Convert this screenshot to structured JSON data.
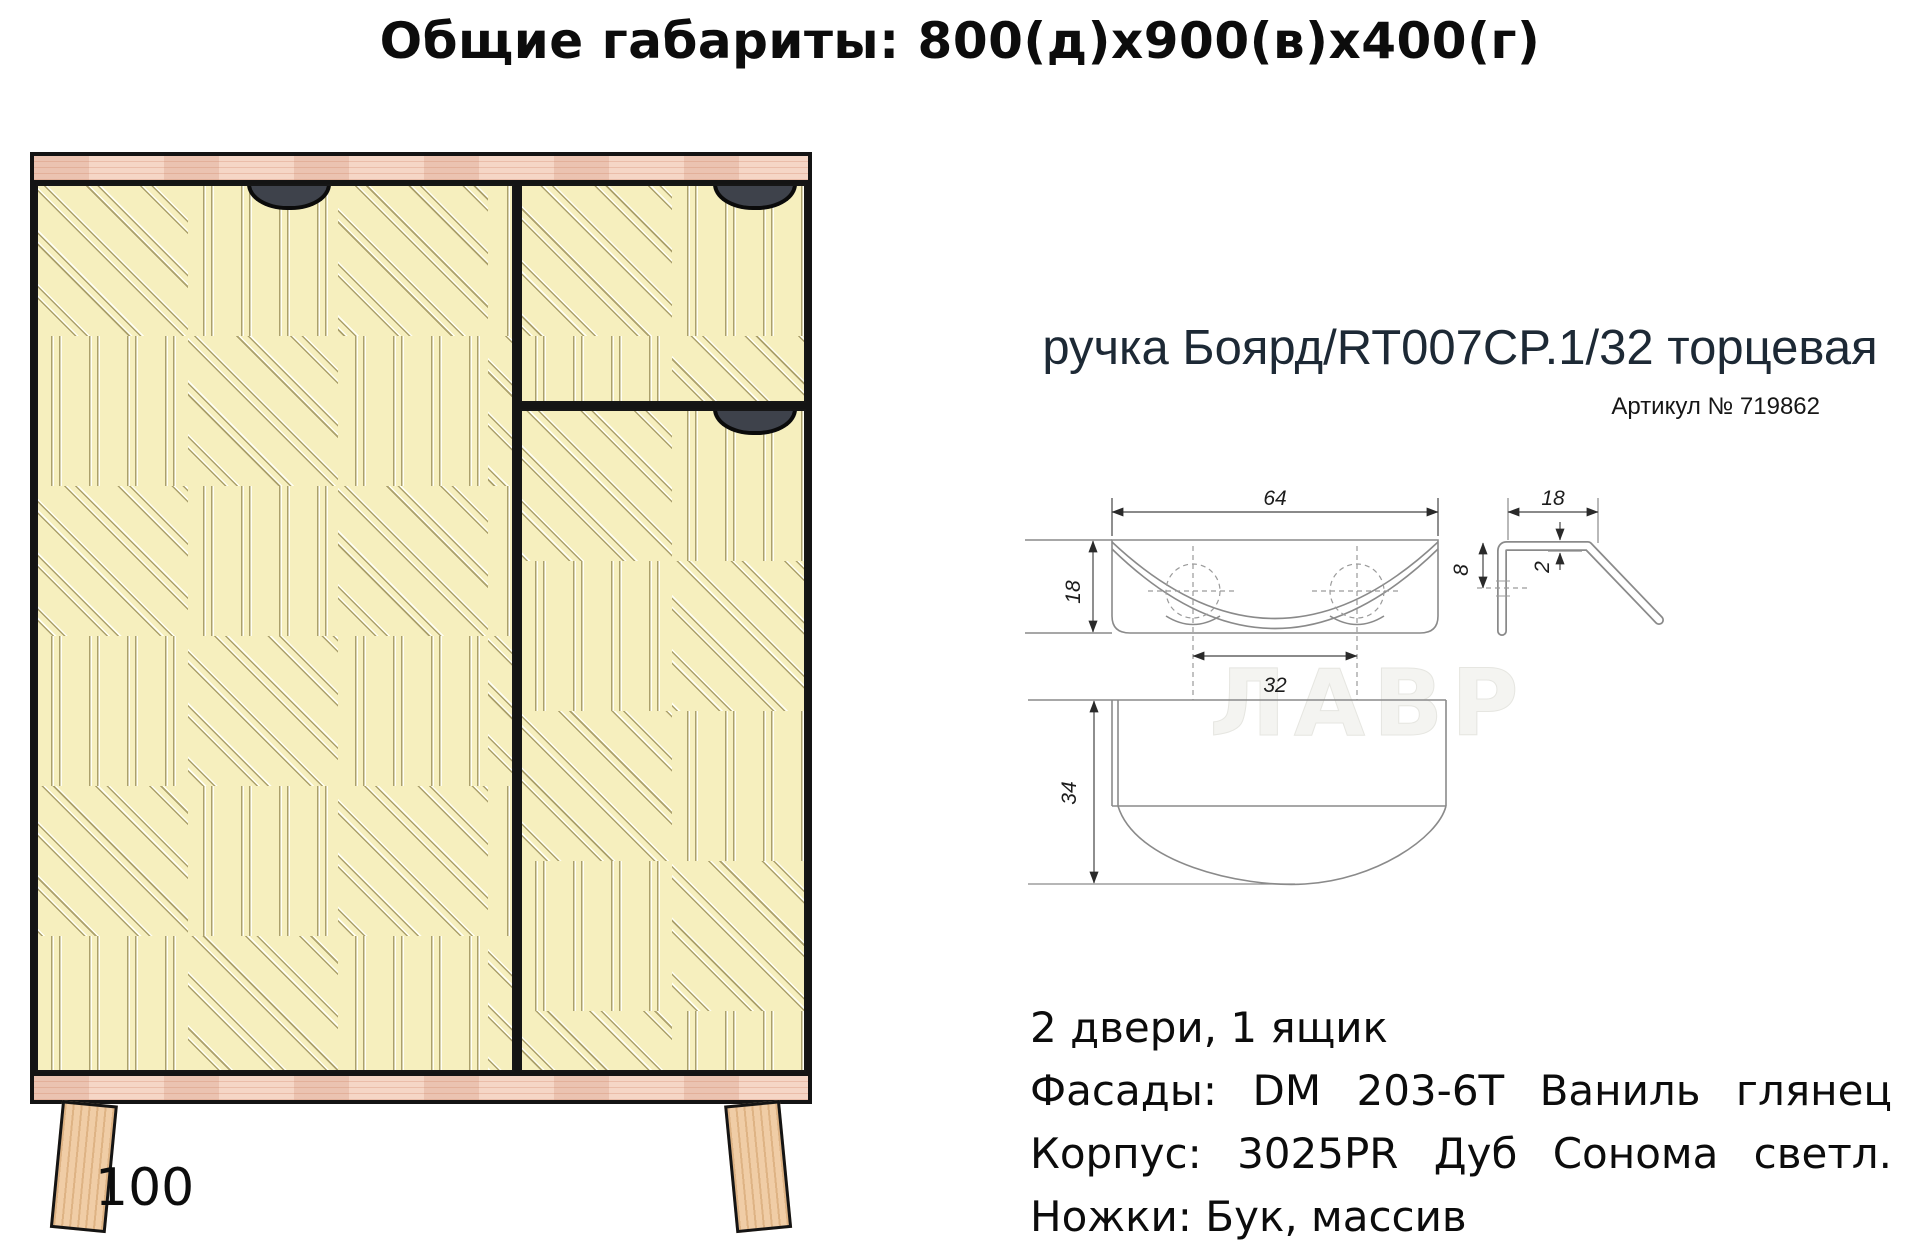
{
  "title": "Общие габариты: 800(д)х900(в)х400(г)",
  "cabinet": {
    "leg_height_label": "100"
  },
  "handle": {
    "name": "ручка Боярд/RT007CP.1/32 торцевая",
    "article": "Артикул № 719862",
    "watermark": "ЛАВР",
    "dims": {
      "front_width": "64",
      "front_height": "18",
      "hole_spacing": "32",
      "top_width": "18",
      "hole_offset": "8",
      "thickness": "2",
      "depth": "34"
    }
  },
  "specs": {
    "doors": "2 двери, 1 ящик",
    "facades": "Фасады: DM 203-6T Ваниль глянец",
    "carcass": "Корпус: 3025PR Дуб Сонома светл.",
    "legs": "Ножки: Бук, массив"
  },
  "colors": {
    "facade": "#f6efbe",
    "groove": "#7a6a34",
    "wood": "#f5d6c6",
    "legwood": "#f0cda6",
    "outline": "#141414",
    "cutout": "#3e424b",
    "line": "#8a8a8a",
    "heading": "#1d2935"
  }
}
